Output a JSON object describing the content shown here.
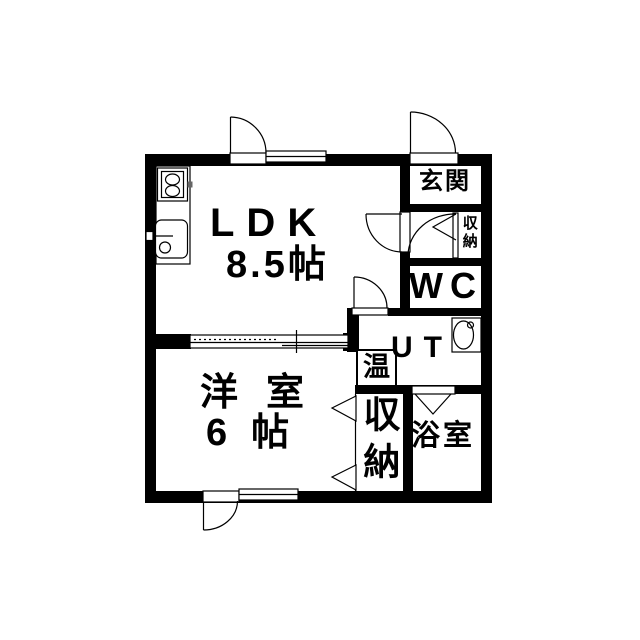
{
  "rooms": {
    "ldk": {
      "label": "LDK",
      "area": "8.5帖"
    },
    "western": {
      "label": "洋室",
      "area": "6帖"
    },
    "entrance": {
      "label": "玄関"
    },
    "toilet": {
      "label": "WC"
    },
    "utility": {
      "label": "UT"
    },
    "bathroom": {
      "label": "浴室"
    },
    "water_heater": {
      "label": "温"
    },
    "hall_closet": {
      "label": "収納"
    },
    "room_closet": {
      "label": "収納"
    }
  },
  "fixtures": {
    "stove": "gas-stove-2-burner",
    "sink": "kitchen-sink",
    "basin": "wash-basin"
  },
  "colors": {
    "wall": "#000000",
    "floor": "#ffffff",
    "line": "#000000"
  }
}
